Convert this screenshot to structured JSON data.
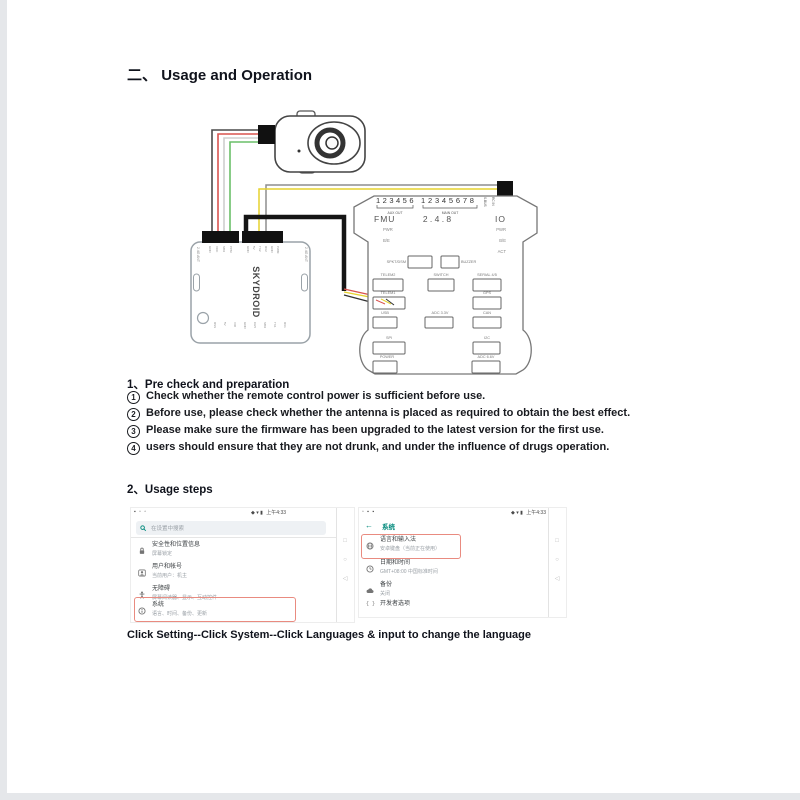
{
  "page": {
    "title_prefix": "二、",
    "title": "Usage and Operation",
    "caption": "Click Setting--Click System--Click Languages & input to change the language",
    "colors": {
      "heading": "#10131c",
      "highlight_red": "#e98b80",
      "android_teal": "#00897b",
      "wire_red": "#d9534f",
      "wire_green": "#6abf69",
      "wire_yellow": "#e6d22e",
      "wire_gray": "#8d8d8d"
    }
  },
  "section1": {
    "heading": "1、Pre check and preparation",
    "items": [
      {
        "num": "1",
        "text": "Check whether the remote control power is sufficient before use."
      },
      {
        "num": "2",
        "text": "Before use, please check whether the antenna is placed as required to obtain the best effect."
      },
      {
        "num": "3",
        "text": "Please make sure the firmware has been upgraded to the latest version for the first use."
      },
      {
        "num": "4",
        "text": "users should ensure that they are not drunk, and under the influence of drugs operation."
      }
    ]
  },
  "section2": {
    "heading": "2、Usage steps"
  },
  "diagram": {
    "receiver": {
      "brand": "SKYDROID",
      "ant_left": "2.4G ANT",
      "ant_right": "2.4G ANT",
      "pins_left": [
        "GND",
        "VCC",
        "SBU",
        "PPM"
      ],
      "pins_right": [
        "GND",
        "5V",
        "TX2",
        "RX2",
        "GND",
        "PWM"
      ],
      "pins_bottom": [
        "RSS",
        "5V",
        "VID",
        "GND",
        "CH5",
        "SBU",
        "TX1",
        "RX1"
      ]
    },
    "fc": {
      "aux_pins": "123456",
      "aux_label": "AUX OUT",
      "main_pins": "12345678",
      "main_label": "MAIN OUT",
      "sbus": "S.BUS",
      "rcin": "RC IN",
      "fmu": "FMU",
      "version": "2 . 4 . 8",
      "io": "IO",
      "pwr_left": "PWR",
      "be_left": "B/E",
      "pwr_right": "PWR",
      "be_right": "B/E",
      "act": "ACT",
      "spkt": "SPKT/DSM",
      "buzzer": "BUZZER",
      "telem2": "TELEM2",
      "switch": "SWITCH",
      "serial45": "SERIAL 4/5",
      "telem1": "TELEM1",
      "gps": "GPS",
      "usb": "USB",
      "adc33": "ADC 3.3V",
      "can": "CAN",
      "spi": "SPI",
      "i2c": "I2C",
      "power": "POWER",
      "adc66": "ADC 6.6V"
    }
  },
  "screen_left": {
    "status": {
      "left_icons": "▪ ▫ ▫",
      "right_icons": "◆ ▾ ▮",
      "time": "上午4:33"
    },
    "search_placeholder": "在设置中搜索",
    "items": [
      {
        "icon": "lock",
        "title": "安全性和位置信息",
        "subtitle": "屏幕锁定"
      },
      {
        "icon": "user-card",
        "title": "用户和帐号",
        "subtitle": "当前用户：机主"
      },
      {
        "icon": "accessibility",
        "title": "无障碍",
        "subtitle": "屏幕阅读器、显示、互动控件"
      },
      {
        "icon": "info",
        "title": "系统",
        "subtitle": "语言、时间、备份、更新"
      }
    ],
    "nav": {
      "square": "□",
      "circle": "○",
      "back": "◁"
    }
  },
  "screen_right": {
    "status": {
      "left_icons": "▫ ▪ ▪",
      "right_icons": "◆ ▾ ▮",
      "time": "上午4:33"
    },
    "back_arrow": "←",
    "header": "系统",
    "items": [
      {
        "icon": "globe",
        "title": "语言和输入法",
        "subtitle": "安卓键盘（当前正在使用）"
      },
      {
        "icon": "clock",
        "title": "日期和时间",
        "subtitle": "GMT+08:00 中国标准时间"
      },
      {
        "icon": "backup-cloud",
        "title": "备份",
        "subtitle": "关闭"
      },
      {
        "icon": "dev-braces",
        "title": "开发者选项",
        "subtitle": ""
      }
    ],
    "nav": {
      "square": "□",
      "circle": "○",
      "back": "◁"
    }
  }
}
